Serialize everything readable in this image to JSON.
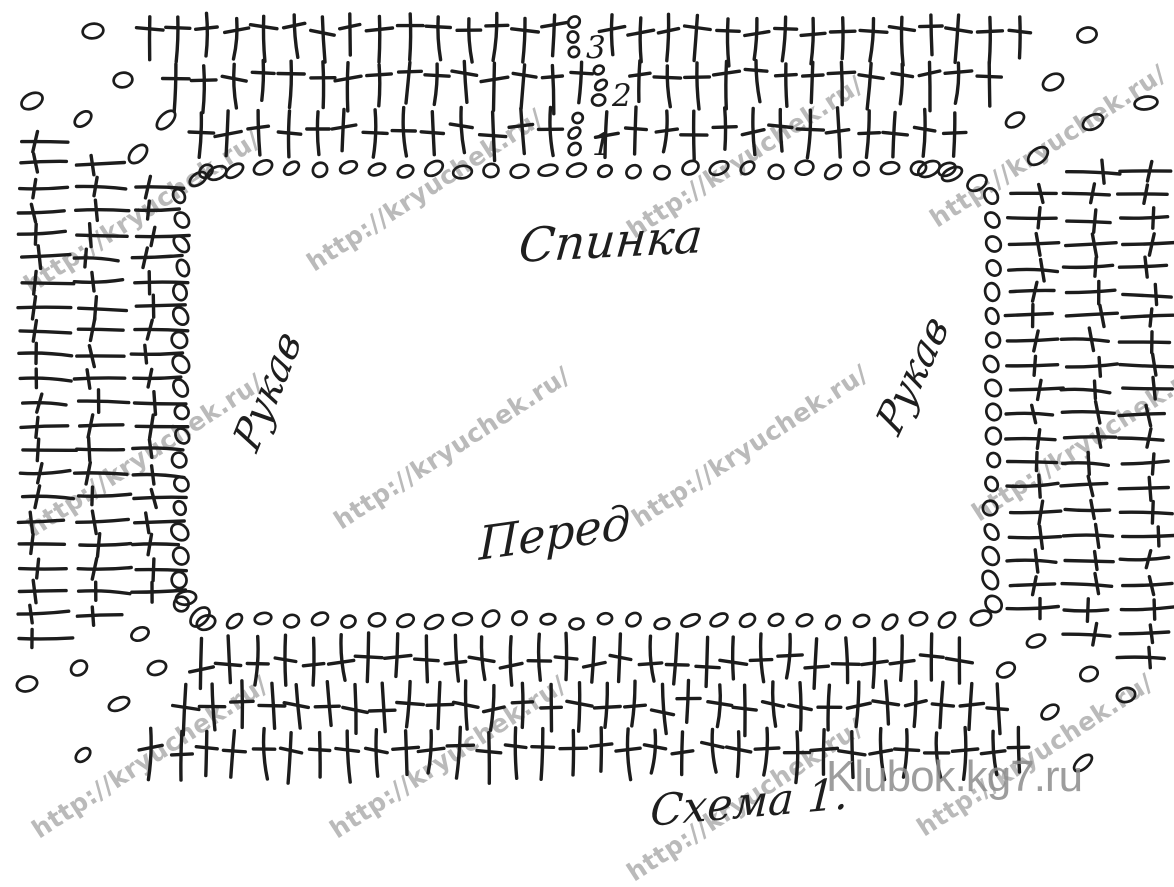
{
  "diagram": {
    "labels": {
      "back": "Спинка",
      "front": "Перед",
      "sleeve_left": "Рукав",
      "sleeve_right": "Рукав",
      "caption": "Схема 1."
    },
    "row_numbers": [
      "3",
      "2",
      "1"
    ],
    "watermark_text": "http://kryuchek.ru/",
    "site_watermark": "Klubok.kg7.ru",
    "colors": {
      "ink": "#1c1c1c",
      "watermark": "#a9a9a9",
      "site_watermark": "#8d8d8d",
      "background": "#ffffff"
    },
    "symbols": {
      "dc-stitch-icon": "double crochet (T bar)",
      "chain-stitch-icon": "chain loop (oval)"
    },
    "watermarks": [
      [
        142,
        212
      ],
      [
        425,
        190
      ],
      [
        745,
        157
      ],
      [
        1048,
        146
      ],
      [
        145,
        455
      ],
      [
        452,
        448
      ],
      [
        750,
        446
      ],
      [
        1090,
        440
      ],
      [
        150,
        757
      ],
      [
        448,
        757
      ],
      [
        745,
        800
      ],
      [
        1035,
        755
      ]
    ],
    "geometry": {
      "top_block": {
        "rows": [
          {
            "x0": 148,
            "x1": 1030,
            "step": 29,
            "y": 16,
            "stem": 44,
            "bar": 0.3,
            "skip_x": 574,
            "stack": {
              "x": 574,
              "ys": [
                22,
                37,
                52
              ],
              "digit": "3",
              "dx": 586,
              "dy": 58
            }
          },
          {
            "x0": 176,
            "x1": 1000,
            "step": 29,
            "y": 63,
            "stem": 44,
            "bar": 0.28,
            "skip_x": 600,
            "stack": {
              "x": 600,
              "ys": [
                70,
                85,
                100
              ],
              "digit": "2",
              "dx": 612,
              "dy": 106
            }
          },
          {
            "x0": 201,
            "x1": 976,
            "step": 29,
            "y": 110,
            "stem": 45,
            "bar": 0.45,
            "skip_x": 576,
            "stack": {
              "x": 576,
              "ys": [
                118,
                133,
                149
              ],
              "digit": "1",
              "dx": 592,
              "dy": 155
            }
          }
        ],
        "chain_row": {
          "x0": 206,
          "x1": 963,
          "step": 28.5,
          "y": 170
        }
      },
      "bottom_block": {
        "chain_row": {
          "x0": 206,
          "x1": 963,
          "step": 28.5,
          "y": 621
        },
        "rows": [
          {
            "x0": 202,
            "x1": 981,
            "step": 28,
            "y": 636,
            "stem": 46,
            "bar": 0.55
          },
          {
            "x0": 186,
            "x1": 1003,
            "step": 28,
            "y": 683,
            "stem": 46,
            "bar": 0.5
          },
          {
            "x0": 152,
            "x1": 1026,
            "step": 28,
            "y": 730,
            "stem": 47,
            "bar": 0.42
          }
        ]
      },
      "left_block": {
        "y0": 140,
        "step": 23.8,
        "rows": 22,
        "cols": [
          20,
          77,
          134
        ],
        "len": 48,
        "bar": 0.32,
        "chain_col": {
          "x": 181,
          "y0": 196,
          "y1": 606,
          "step": 24
        }
      },
      "right_block": {
        "y0": 171,
        "step": 24.3,
        "rows": 21,
        "cols": [
          1008,
          1064,
          1120
        ],
        "len": 48,
        "bar": 0.62,
        "chain_col": {
          "x": 992,
          "y0": 196,
          "y1": 606,
          "step": 24
        }
      },
      "corner_chains": {
        "top_left": [
          [
            93,
            31
          ],
          [
            32,
            101
          ],
          [
            123,
            80
          ],
          [
            83,
            119
          ],
          [
            166,
            120
          ],
          [
            138,
            154
          ],
          [
            198,
            179
          ],
          [
            217,
            173
          ]
        ],
        "top_right": [
          [
            1087,
            35
          ],
          [
            1053,
            82
          ],
          [
            1146,
            103
          ],
          [
            1015,
            120
          ],
          [
            1093,
            122
          ],
          [
            1038,
            156
          ],
          [
            929,
            169
          ],
          [
            952,
            174
          ],
          [
            977,
            183
          ]
        ],
        "bottom_left": [
          [
            186,
            598
          ],
          [
            200,
            617
          ],
          [
            140,
            634
          ],
          [
            157,
            668
          ],
          [
            79,
            668
          ],
          [
            27,
            684
          ],
          [
            119,
            704
          ],
          [
            83,
            755
          ]
        ],
        "bottom_right": [
          [
            981,
            618
          ],
          [
            1006,
            670
          ],
          [
            1036,
            641
          ],
          [
            1089,
            674
          ],
          [
            1126,
            695
          ],
          [
            1050,
            712
          ],
          [
            1083,
            763
          ]
        ]
      }
    }
  }
}
